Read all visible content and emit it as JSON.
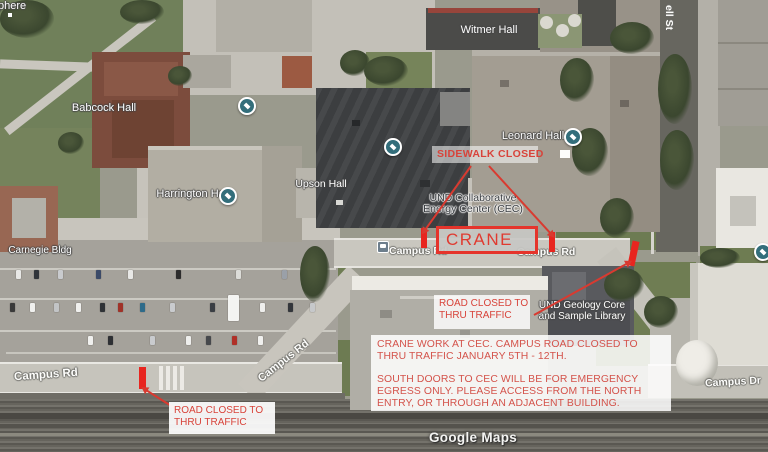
{
  "map": {
    "watermark": "Google Maps",
    "labels": {
      "partial_top_left": "phere",
      "witmer": "Witmer Hall",
      "babcock": "Babcock Hall",
      "harrington": "Harrington Hall",
      "upson": "Upson Hall",
      "leonard": "Leonard Hall",
      "carnegie": "Carnegie Bldg",
      "cec_line1": "UND Collaborative",
      "cec_line2": "Energy Center (CEC)",
      "geology_line1": "UND Geology Core",
      "geology_line2": "and Sample Library"
    },
    "roads": {
      "campus_rd": "Campus Rd",
      "campus_dr": "Campus Dr",
      "cornell_st_partial": "ell St"
    },
    "icons": {
      "poi": "school-poi-icon",
      "transit": "bus-stop-icon"
    }
  },
  "annotations": {
    "sidewalk_closed": "SIDEWALK CLOSED",
    "crane_label": "CRANE",
    "road_closed_line1": "ROAD CLOSED TO",
    "road_closed_line2": "THRU TRAFFIC",
    "notice_para1": "CRANE WORK AT CEC. CAMPUS ROAD CLOSED TO THRU TRAFFIC JANUARY 5TH - 12TH.",
    "notice_para2": "SOUTH DOORS TO CEC WILL BE FOR EMERGENCY EGRESS ONLY. PLEASE ACCESS FROM THE NORTH ENTRY, OR THROUGH AN ADJACENT BUILDING.",
    "colors": {
      "annotation_red": "#d4534b",
      "marker_red": "#e8251f",
      "crane_box_fill": "#c7c7c4"
    }
  }
}
